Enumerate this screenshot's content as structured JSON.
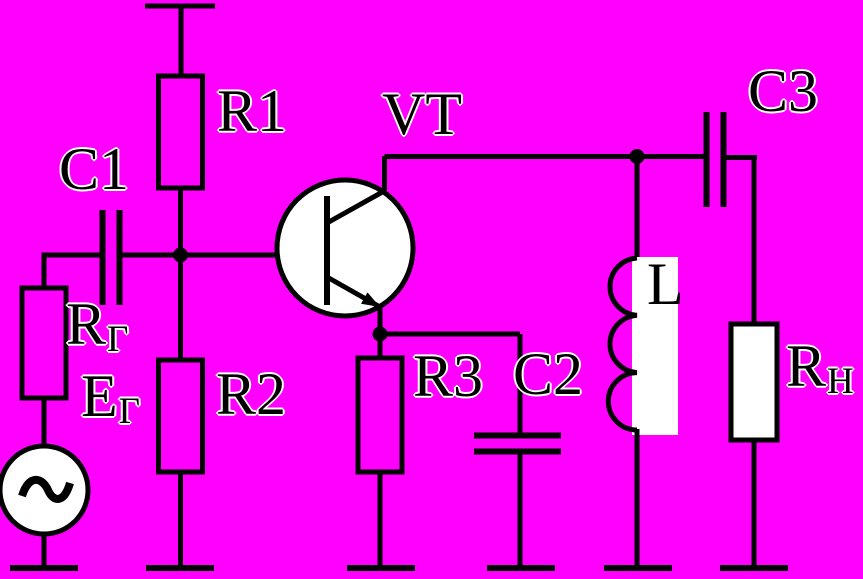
{
  "diagram": {
    "kind": "circuit-schematic",
    "description": "Single-stage transistor amplifier with inductive collector load, driven by an AC generator and coupled to a load resistor",
    "colors": {
      "background": "#ff00ff",
      "stroke": "#000000",
      "component_fill": "#ffffff"
    },
    "labels": {
      "c1": {
        "text": "C1"
      },
      "r1": {
        "text": "R1"
      },
      "vt": {
        "text": "VT"
      },
      "c3": {
        "text": "C3"
      },
      "rg": {
        "main": "R",
        "sub": "Г"
      },
      "eg": {
        "main": "Е",
        "sub": "Г"
      },
      "r2": {
        "text": "R2"
      },
      "r3": {
        "text": "R3"
      },
      "c2": {
        "text": "C2"
      },
      "l": {
        "text": "L"
      },
      "rn": {
        "main": "R",
        "sub": "Н"
      }
    },
    "components": [
      {
        "id": "supply-terminal",
        "type": "power-rail-terminal",
        "label": ""
      },
      {
        "id": "R1",
        "type": "resistor",
        "label": "R1"
      },
      {
        "id": "C1",
        "type": "capacitor",
        "label": "C1"
      },
      {
        "id": "RG",
        "type": "resistor",
        "label": "RГ"
      },
      {
        "id": "EG",
        "type": "ac-voltage-source",
        "label": "ЕГ"
      },
      {
        "id": "R2",
        "type": "resistor",
        "label": "R2"
      },
      {
        "id": "VT",
        "type": "npn-transistor",
        "label": "VT"
      },
      {
        "id": "R3",
        "type": "resistor",
        "label": "R3"
      },
      {
        "id": "C2",
        "type": "capacitor",
        "label": "C2"
      },
      {
        "id": "L",
        "type": "inductor",
        "label": "L"
      },
      {
        "id": "C3",
        "type": "capacitor",
        "label": "C3"
      },
      {
        "id": "RN",
        "type": "resistor",
        "label": "RН"
      }
    ],
    "ground_count": 6
  }
}
